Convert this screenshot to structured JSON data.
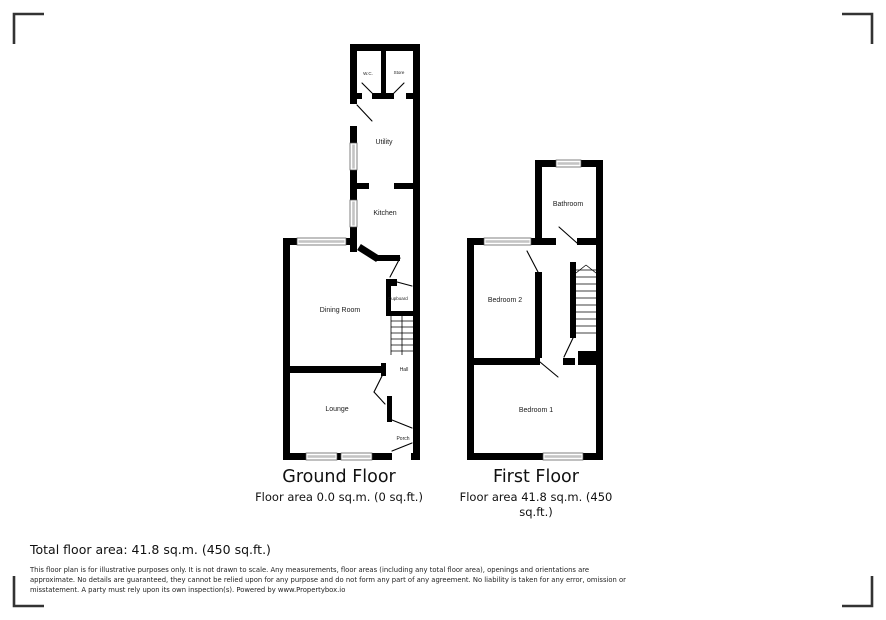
{
  "ground_floor": {
    "title": "Ground Floor",
    "area": "Floor area 0.0 sq.m. (0 sq.ft.)",
    "rooms": {
      "wc": "W.C.",
      "store": "Store",
      "utility": "Utility",
      "kitchen": "Kitchen",
      "dining_room": "Dining Room",
      "cupboard": "Cupboard",
      "hall": "Hall",
      "lounge": "Lounge",
      "porch": "Porch"
    }
  },
  "first_floor": {
    "title": "First Floor",
    "area": "Floor area 41.8 sq.m. (450 sq.ft.)",
    "rooms": {
      "bathroom": "Bathroom",
      "bedroom2": "Bedroom 2",
      "bedroom1": "Bedroom 1"
    }
  },
  "summary": {
    "total_area": "Total floor area: 41.8 sq.m. (450 sq.ft.)"
  },
  "disclaimer": "This floor plan is for illustrative purposes only. It is not drawn to scale. Any measurements, floor areas (including any total floor area), openings and orientations are approximate. No details are guaranteed, they cannot be relied upon for any purpose and do not form any part of any agreement. No liability is taken for any error, omission or misstatement. A party must rely upon its own inspection(s). Powered by www.Propertybox.io",
  "colors": {
    "wall": "#000000",
    "window_glass": "#c4c4c4",
    "corner_mark": "#333333"
  }
}
